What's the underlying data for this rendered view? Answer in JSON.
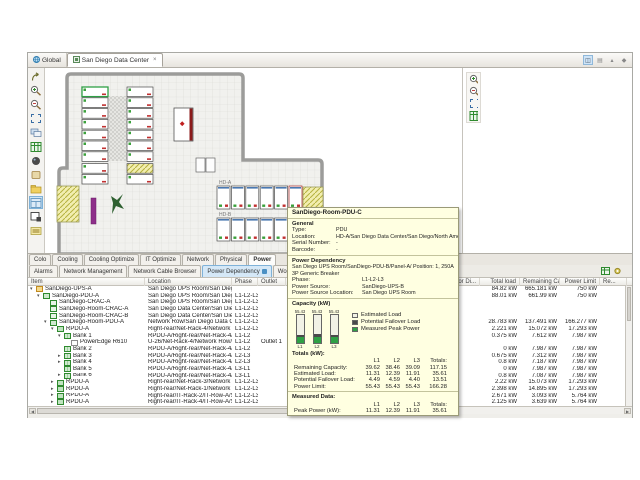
{
  "colors": {
    "accent_blue": "#4a90c4",
    "tooltip_bg": "#ffffe1",
    "estimated_load": "#f2f2e6",
    "potential_failover_load": "#4a4a4a",
    "measured_peak_power": "#2fa045",
    "selection": "#cde6f7"
  },
  "tabs": {
    "items": [
      {
        "label": "Global",
        "active": false
      },
      {
        "label": "San Diego Data Center",
        "active": true
      }
    ]
  },
  "map_toolbar": [
    {
      "name": "select"
    },
    {
      "name": "zoom-in"
    },
    {
      "name": "zoom-out"
    },
    {
      "name": "zoom-fit"
    },
    {
      "name": "layers"
    },
    {
      "name": "table-view"
    },
    {
      "name": "filter"
    },
    {
      "name": "tag"
    },
    {
      "name": "export"
    },
    {
      "name": "layout",
      "selected": true
    },
    {
      "name": "frame"
    },
    {
      "name": "legend"
    }
  ],
  "minimap_toolbar": [
    {
      "name": "zoom-in"
    },
    {
      "name": "zoom-out"
    },
    {
      "name": "zoom-fit"
    },
    {
      "name": "table-view"
    }
  ],
  "floor_plan": {
    "row_labels": [
      "HD-A",
      "HD-B"
    ]
  },
  "tooltip": {
    "title": "SanDiego-Room-PDU-C",
    "sections": {
      "general": {
        "heading": "General",
        "rows": [
          {
            "label": "Type:",
            "value": "PDU"
          },
          {
            "label": "Location:",
            "value": "HD-A/San Diego Data Center/San Diego/North America/"
          },
          {
            "label": "Serial Number:",
            "value": "-"
          },
          {
            "label": "Barcode:",
            "value": "-"
          }
        ]
      },
      "power_dependency": {
        "heading": "Power Dependency",
        "line": "San Diego UPS Room/SanDiego-PDU-B/Panel-A/ Position:  1, 250A 3P Generic Breaker",
        "rows": [
          {
            "label": "Phase:",
            "value": "L1-L2-L3"
          },
          {
            "label": "Power Source:",
            "value": "SanDiego-UPS-B"
          },
          {
            "label": "Power Source Location:",
            "value": "San Diego UPS Room"
          }
        ]
      },
      "capacity": {
        "heading": "Capacity (kW)",
        "gauges": [
          {
            "phase": "L1",
            "limit": 55.43,
            "measured": 11.31,
            "failover": 4.49
          },
          {
            "phase": "L2",
            "limit": 55.43,
            "measured": 12.39,
            "failover": 4.59
          },
          {
            "phase": "L3",
            "limit": 55.43,
            "measured": 11.91,
            "failover": 4.4
          }
        ],
        "legend": [
          "Estimated Load",
          "Potential Failover Load",
          "Measured Peak Power"
        ]
      },
      "totals": {
        "heading": "Totals (kW):",
        "columns": [
          "L1",
          "L2",
          "L3",
          "Totals:"
        ],
        "rows": [
          {
            "label": "Remaining Capacity:",
            "values": [
              "39.62",
              "38.46",
              "39.09",
              "117.15"
            ]
          },
          {
            "label": "Estimated Load:",
            "values": [
              "11.31",
              "12.39",
              "11.91",
              "35.61"
            ]
          },
          {
            "label": "Potential Failover Load:",
            "values": [
              "4.49",
              "4.59",
              "4.40",
              "13.51"
            ]
          },
          {
            "label": "Power Limit:",
            "values": [
              "55.43",
              "55.43",
              "55.43",
              "166.28"
            ]
          }
        ]
      },
      "measured": {
        "heading": "Measured Data:",
        "columns": [
          "L1",
          "L2",
          "L3",
          "Totals:"
        ],
        "rows": [
          {
            "label": "Peak Power (kW):",
            "values": [
              "11.31",
              "12.39",
              "11.91",
              "35.61"
            ]
          }
        ]
      }
    }
  },
  "bottom_tabs": {
    "row1": [
      {
        "label": "Colo"
      },
      {
        "label": "Cooling"
      },
      {
        "label": "Cooling Optimize"
      },
      {
        "label": "IT Optimize"
      },
      {
        "label": "Network"
      },
      {
        "label": "Physical"
      },
      {
        "label": "Power",
        "active": true
      }
    ],
    "row2": [
      {
        "label": "Alarms"
      },
      {
        "label": "Network Management"
      },
      {
        "label": "Network Cable Browser"
      },
      {
        "label": "Power Dependency",
        "active": true
      },
      {
        "label": "Work Orders"
      },
      {
        "label": "Equipment Browser"
      }
    ]
  },
  "table": {
    "headers": [
      {
        "label": "Item",
        "w": 117,
        "align": "left"
      },
      {
        "label": "Location",
        "w": 87,
        "align": "left"
      },
      {
        "label": "Phase",
        "w": 26,
        "align": "left"
      },
      {
        "label": "Outlet",
        "w": 28,
        "align": "left"
      },
      {
        "label": "ed for Di...",
        "w": 194,
        "align": "right"
      },
      {
        "label": "Total load",
        "w": 40,
        "align": "right"
      },
      {
        "label": "Remaining Ca...",
        "w": 40,
        "align": "right"
      },
      {
        "label": "Power Limit",
        "w": 40,
        "align": "right"
      },
      {
        "label": "Re...",
        "w": 27,
        "align": "left"
      }
    ],
    "rows": [
      {
        "item": "SanDiego-UPS-A",
        "indent": 0,
        "expand": "open",
        "icon": "ups",
        "location": "San Diego UPS Room/San Diego/...",
        "phase": "",
        "outlet": "",
        "total": "84.82 kW",
        "remaining": "665.181 kW",
        "limit": "750 kW"
      },
      {
        "item": "SanDiego-PDU-A",
        "indent": 1,
        "expand": "open",
        "icon": "pdu",
        "location": "San Diego UPS Room/San Diego/...",
        "phase": "L1-L2-L3",
        "outlet": "",
        "total": "88.01 kW",
        "remaining": "661.99 kW",
        "limit": "750 kW"
      },
      {
        "item": "SanDiego-CRAC-A",
        "indent": 2,
        "expand": "",
        "icon": "crac",
        "location": "San Diego UPS Room/San Diego/...",
        "phase": "L1-L2-L3",
        "outlet": "",
        "total": "",
        "remaining": "",
        "limit": ""
      },
      {
        "item": "SanDiego-Room-CRAC-A",
        "indent": 2,
        "expand": "",
        "icon": "crac",
        "location": "San Diego Data Center/San Diego/...",
        "phase": "L1-L2-L3",
        "outlet": "",
        "total": "",
        "remaining": "",
        "limit": ""
      },
      {
        "item": "SanDiego-Room-CRAC-B",
        "indent": 2,
        "expand": "",
        "icon": "crac",
        "location": "San Diego Data Center/San Diego/...",
        "phase": "L1-L2-L3",
        "outlet": "",
        "total": "",
        "remaining": "",
        "limit": ""
      },
      {
        "item": "SanDiego-Room-PDU-A",
        "indent": 2,
        "expand": "open",
        "icon": "pdu",
        "location": "Network Row/San Diego Data Cen...",
        "phase": "L1-L2-L3",
        "outlet": "",
        "total": "28.783 kW",
        "remaining": "137.491 kW",
        "limit": "166.277 kW"
      },
      {
        "item": "RPDU-A",
        "indent": 3,
        "expand": "open",
        "icon": "rpdu",
        "location": "Right-rear/Net-Rack-4/Network R...",
        "phase": "L1-L2-L3",
        "outlet": "",
        "total": "2.221 kW",
        "remaining": "15.072 kW",
        "limit": "17.293 kW"
      },
      {
        "item": "Bank 1",
        "indent": 4,
        "expand": "open",
        "icon": "bank",
        "location": "RPDU-A/Right-rear/Net-Rack-4/N...",
        "phase": "L1-L2",
        "outlet": "",
        "total": "0.375 kW",
        "remaining": "7.612 kW",
        "limit": "7.987 kW"
      },
      {
        "item": "PowerEdge R610",
        "indent": 5,
        "expand": "",
        "icon": "server",
        "location": "U-26/Net-Rack-4/Network Row/Sa...",
        "phase": "L1-L2",
        "outlet": "Outlet 1",
        "total": "",
        "remaining": "",
        "limit": ""
      },
      {
        "item": "Bank 2",
        "indent": 4,
        "expand": "",
        "icon": "bank",
        "location": "RPDU-A/Right-rear/Net-Rack-4/N...",
        "phase": "L1-L2",
        "outlet": "",
        "total": "0 kW",
        "remaining": "7.987 kW",
        "limit": "7.987 kW"
      },
      {
        "item": "Bank 3",
        "indent": 4,
        "expand": "closed",
        "icon": "bank",
        "location": "RPDU-A/Right-rear/Net-Rack-4/N...",
        "phase": "L2-L3",
        "outlet": "",
        "total": "0.675 kW",
        "remaining": "7.312 kW",
        "limit": "7.987 kW"
      },
      {
        "item": "Bank 4",
        "indent": 4,
        "expand": "closed",
        "icon": "bank",
        "location": "RPDU-A/Right-rear/Net-Rack-4/N...",
        "phase": "L2-L3",
        "outlet": "",
        "total": "0.8 kW",
        "remaining": "7.187 kW",
        "limit": "7.987 kW"
      },
      {
        "item": "Bank 5",
        "indent": 4,
        "expand": "",
        "icon": "bank",
        "location": "RPDU-A/Right-rear/Net-Rack-4/N...",
        "phase": "L3-L1",
        "outlet": "",
        "total": "0 kW",
        "remaining": "7.987 kW",
        "limit": "7.987 kW"
      },
      {
        "item": "Bank 6",
        "indent": 4,
        "expand": "closed",
        "icon": "bank",
        "location": "RPDU-A/Right-rear/Net-Rack-4/N...",
        "phase": "L3-L1",
        "outlet": "",
        "total": "0.8 kW",
        "remaining": "7.087 kW",
        "limit": "7.987 kW"
      },
      {
        "item": "RPDU-A",
        "indent": 3,
        "expand": "closed",
        "icon": "rpdu",
        "location": "Right-rear/Net-Rack-3/Network R...",
        "phase": "L1-L2-L3",
        "outlet": "",
        "total": "2.22 kW",
        "remaining": "15.073 kW",
        "limit": "17.293 kW"
      },
      {
        "item": "RPDU-A",
        "indent": 3,
        "expand": "closed",
        "icon": "rpdu",
        "location": "Right-rear/Net-Rack-1/Network R...",
        "phase": "L1-L2-L3",
        "outlet": "",
        "total": "2.398 kW",
        "remaining": "14.895 kW",
        "limit": "17.293 kW"
      },
      {
        "item": "RPDU-A",
        "indent": 3,
        "expand": "closed",
        "icon": "rpdu",
        "location": "Right-rear/IT-Rack-2/IT-Row-A/Sa...",
        "phase": "L1-L2-L3",
        "outlet": "",
        "total": "2.671 kW",
        "remaining": "3.093 kW",
        "limit": "5.764 kW"
      },
      {
        "item": "RPDU-A",
        "indent": 3,
        "expand": "closed",
        "icon": "rpdu",
        "location": "Right-rear/IT-Rack-4/IT-Row-A/Sa...",
        "phase": "L1-L2-L3",
        "outlet": "",
        "total": "2.125 kW",
        "remaining": "3.639 kW",
        "limit": "5.764 kW"
      }
    ]
  }
}
